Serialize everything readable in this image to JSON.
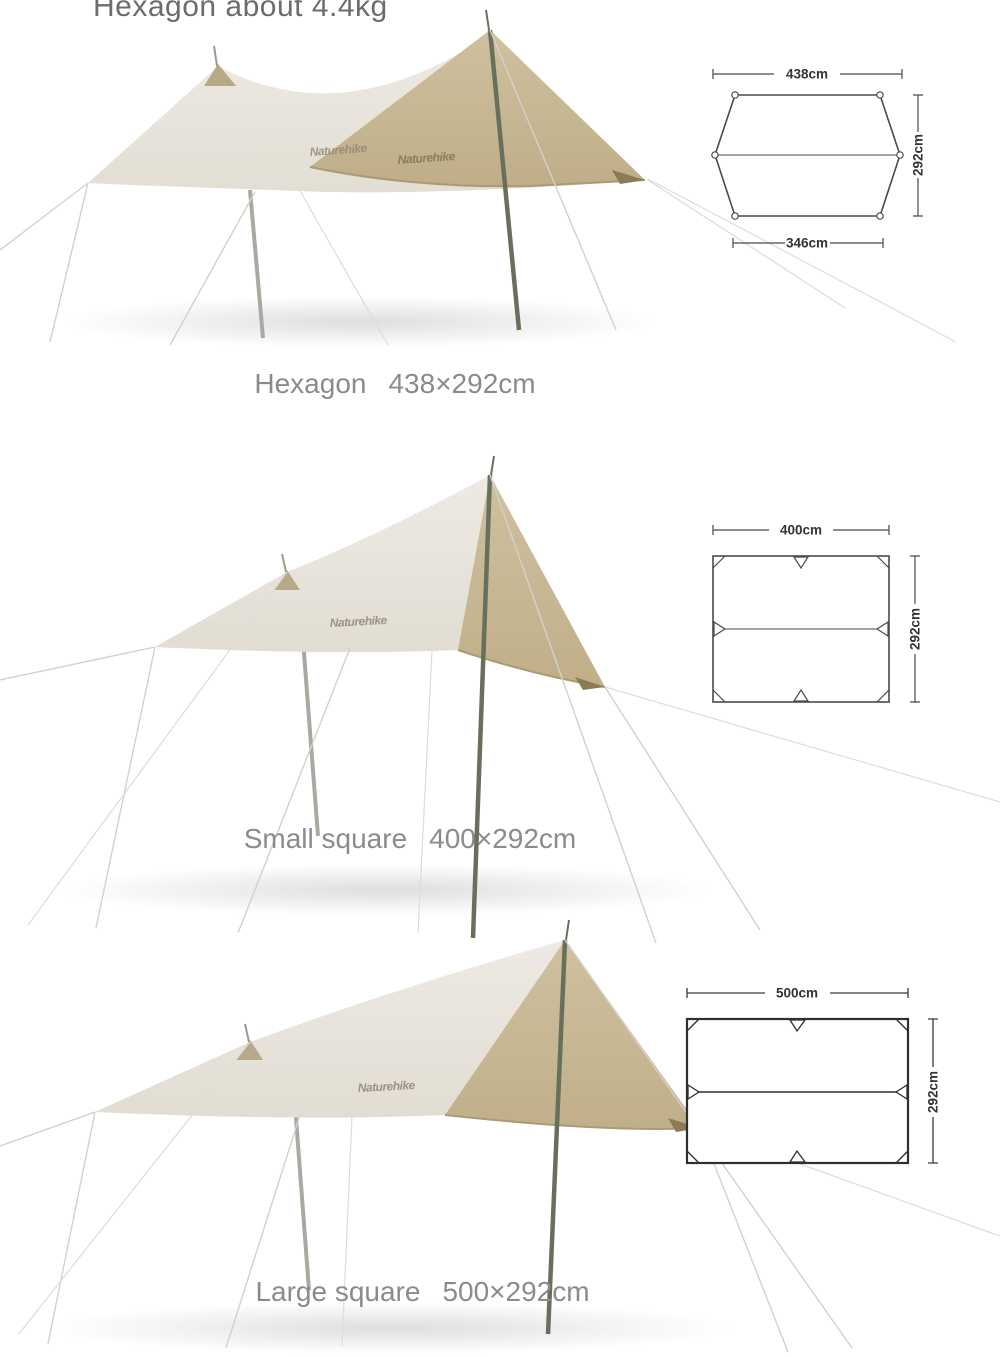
{
  "header": {
    "cropped_title": "Hexagon about 4.4kg"
  },
  "brand": {
    "logo": "Naturehike"
  },
  "sections": [
    {
      "name": "Hexagon",
      "size_label": "438×292cm",
      "diagram": {
        "shape": "hexagon",
        "top_width_label": "438cm",
        "height_label": "292cm",
        "bottom_width_label": "346cm"
      }
    },
    {
      "name": "Small square",
      "size_label": "400×292cm",
      "diagram": {
        "shape": "rectangle",
        "top_width_label": "400cm",
        "height_label": "292cm"
      }
    },
    {
      "name": "Large square",
      "size_label": "500×292cm",
      "diagram": {
        "shape": "rectangle",
        "top_width_label": "500cm",
        "height_label": "292cm"
      }
    }
  ],
  "colors": {
    "background": "#ffffff",
    "fabric_cream": "#e9e5dd",
    "fabric_tan": "#c9b995",
    "fabric_trim": "#ab9a72",
    "corner_patch": "#8c7b54",
    "pole_dark": "#68705c",
    "pole_light": "#a9a9a1",
    "guy_line": "#d3d1cc",
    "diagram_line": "#4a4a4a",
    "diagram_text": "#333333",
    "caption_text": "#8b8b8b",
    "title_text": "#6c6c6c"
  }
}
